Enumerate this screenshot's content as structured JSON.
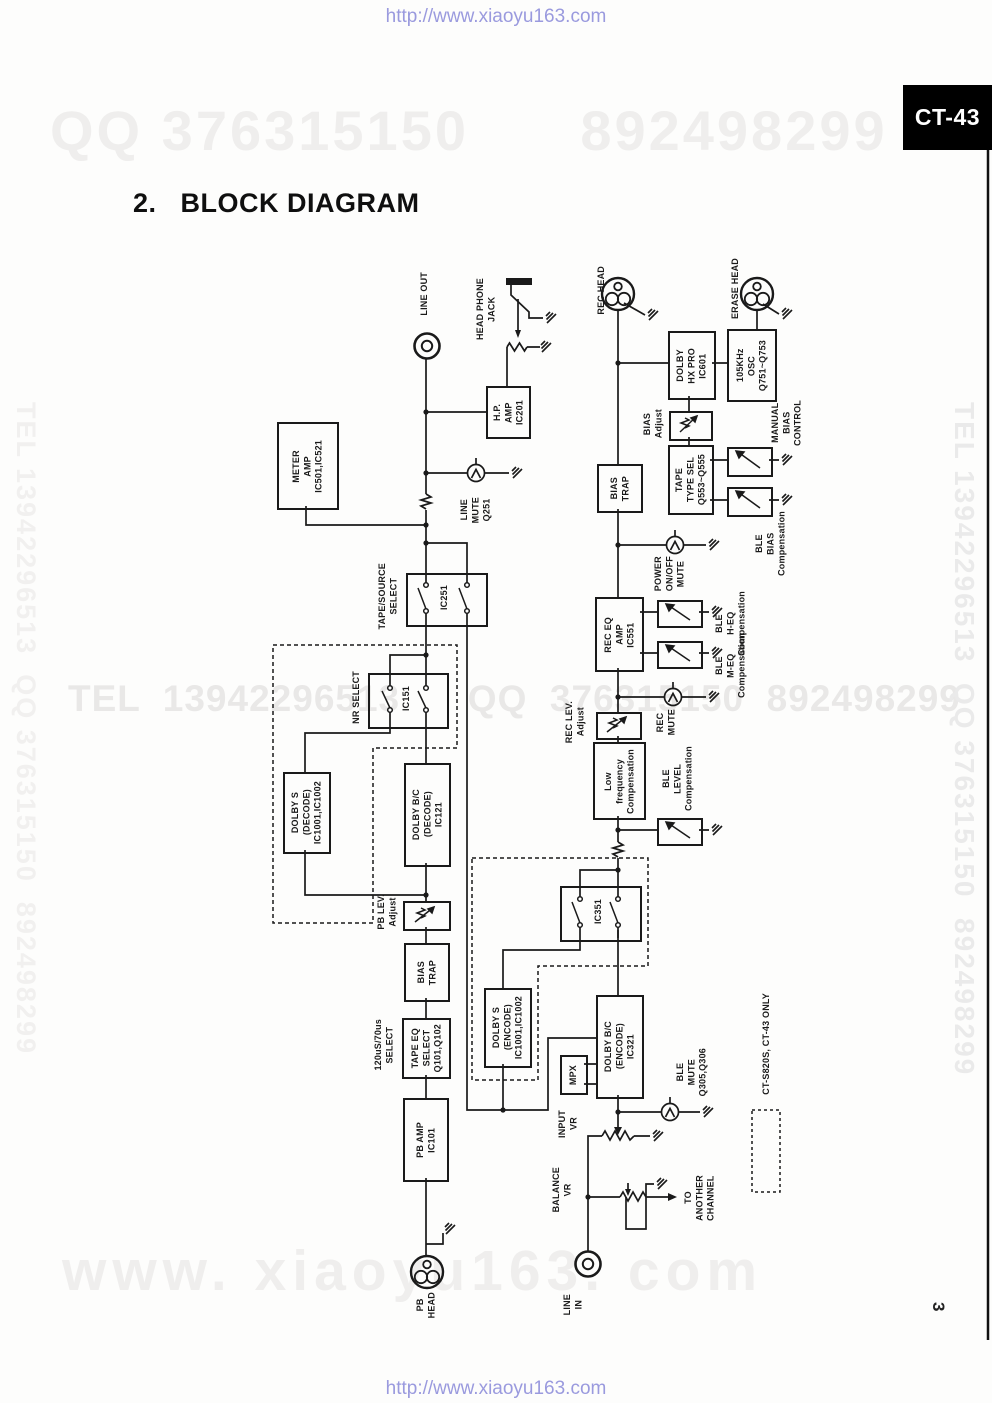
{
  "header": {
    "url": "http://www.xiaoyu163.com",
    "badge": "CT-43",
    "title": "2.   BLOCK DIAGRAM"
  },
  "footer": {
    "url": "http://www.xiaoyu163.com",
    "page_number": "3"
  },
  "watermarks": {
    "top": "QQ 376315150      892498299",
    "middle": "TEL  13942296513      QQ  376315150  892498299",
    "bottom": "www. xiaoyu163. com",
    "left_vertical": "TEL 13942296513  QQ 376315150  892498299",
    "right_vertical": "TEL 13942296513  QQ 376315150  892498299"
  },
  "colors": {
    "paper": "#fdfdfc",
    "ink": "#1a1a1a",
    "badge_bg": "#000000",
    "badge_text": "#ffffff",
    "url_blue": "#9a9ade",
    "watermark_light": "#efeeed"
  },
  "labels": {
    "line_out": "LINE OUT",
    "head_phone_jack": "HEAD PHONE\nJACK",
    "rec_head": "REC HEAD",
    "erase_head": "ERASE HEAD",
    "hp_amp": "H.P.\nAMP\nIC201",
    "meter_amp": "METER\nAMP\nIC501,IC521",
    "line_mute": "LINE\nMUTE\nQ251",
    "dolby_hx": "DOLBY\nHX PRO\nIC601",
    "osc_105k": "105KHz\nOSC\nQ751~Q753",
    "bias_adjust": "BIAS\nAdjust",
    "tape_type_sel": "TAPE\nTYPE SEL\nQ553~Q555",
    "manual_bias": "MANUAL\nBIAS\nCONTROL",
    "ble_bias": "BLE\nBIAS\nCompensation",
    "bias_trap_rec": "BIAS\nTRAP",
    "power_mute": "POWER\nON/OFF\nMUTE",
    "tape_source_sel": "TAPE/SOURCE\nSELECT",
    "ic251": "IC251",
    "rec_eq": "REC EQ\nAMP\nIC551",
    "ble_heq": "BLE\nH-EQ\nCompensation",
    "ble_meq": "BLE\nM-EQ\nCompensation",
    "nr_select": "NR SELECT",
    "ic151": "IC151",
    "rec_mute": "REC\nMUTE",
    "rec_lev": "REC LEV.\nAdjust",
    "low_freq": "Low\nfrequency\nCompensation",
    "ble_level": "BLE\nLEVEL\nCompensation",
    "dolby_s_dec": "DOLBY S\n(DECODE)\nIC1001,IC1002",
    "dolby_bc_dec": "DOLBY B/C\n(DECODE)\nIC121",
    "pb_lev": "PB LEV.\nAdjust",
    "ic351": "IC351",
    "bias_trap_pb": "BIAS\nTRAP",
    "dolby_s_enc": "DOLBY S\n(ENCODE)\nIC1001,IC1002",
    "us_select": "120uS/70us\nSELECT",
    "tape_eq": "TAPE EQ\nSELECT\nQ101,Q102",
    "mpx": "MPX",
    "dolby_bc_enc": "DOLBY B/C\n(ENCODE)\nIC321",
    "ble_mute": "BLE\nMUTE\nQ305,Q306",
    "pb_amp": "PB AMP\nIC101",
    "input_vr": "INPUT\nVR",
    "only_note": "CT-S820S, CT-43 ONLY",
    "balance_vr": "BALANCE\nVR",
    "to_another": "TO\nANOTHER\nCHANNEL",
    "pb_head": "PB\nHEAD",
    "line_in": "LINE\nIN"
  }
}
